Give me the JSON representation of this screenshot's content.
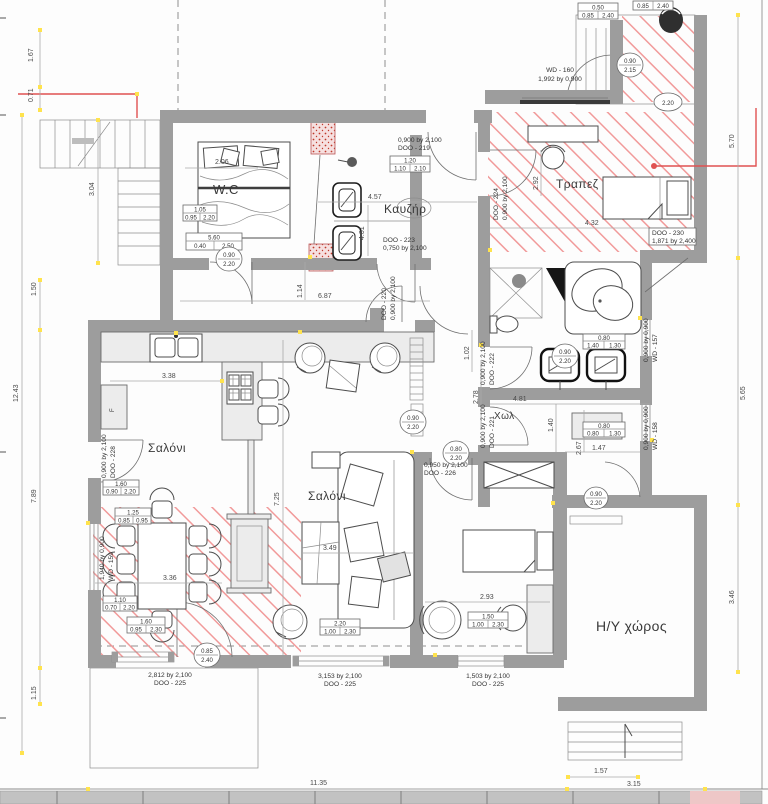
{
  "rooms": {
    "wc": "W.C",
    "boiler": "Καυζήρ",
    "dining": "Τραπεζ",
    "living_left": "Σαλόνι",
    "living_center": "Σαλόνι",
    "hall": "Χωλ",
    "computer_room": "Η/Υ χώρος",
    "fridge": "F"
  },
  "doors": {
    "d219": {
      "size": "0,900 by 2,100",
      "code": "DOO - 219"
    },
    "d220": {
      "code": "DOO - 220",
      "size": "0,900 by 2,100"
    },
    "d221": {
      "size": "0,900 by 2,100",
      "code": "DOO - 221"
    },
    "d222": {
      "size": "0,900 by 2,100",
      "code": "DOO - 222"
    },
    "d223": {
      "code": "DOO - 223",
      "size": "0,750 by 2,100"
    },
    "d224": {
      "code": "DOO - 224",
      "size": "0,900 by 2,100"
    },
    "d225a": {
      "size": "2,812 by 2,100",
      "code": "DOO - 225"
    },
    "d225b": {
      "size": "3,153 by 2,100",
      "code": "DOO - 225"
    },
    "d225c": {
      "size": "1,503 by 2,100",
      "code": "DOO - 225"
    },
    "d226": {
      "size": "0,950 by 2,100",
      "code": "DOO - 226"
    },
    "d228": {
      "size": "0,900 by 2,100",
      "code": "DOO - 228"
    },
    "d230": {
      "code": "DOO - 230",
      "size": "1,871 by 2,400"
    }
  },
  "windows": {
    "w157": {
      "size": "0,900 by 0,900",
      "code": "WD - 157"
    },
    "w158": {
      "size": "0,900 by 0,900",
      "code": "WD - 158"
    },
    "w159": {
      "size": "1,940 by 0,900",
      "code": "WD - 159"
    },
    "w160": {
      "code": "WD - 160",
      "size": "1,992 by 0,900"
    }
  },
  "dimensions": {
    "left": [
      "1.67",
      "0.71",
      "3.04",
      "1.50",
      "12.43",
      "7.89",
      "1.15"
    ],
    "right": [
      "5.70",
      "5.65",
      "3.46"
    ],
    "bottom": [
      "11.35",
      "1.57",
      "3.15"
    ],
    "interior": {
      "a206": "2.06",
      "a457": "4.57",
      "a401": "4.01",
      "a114": "1.14",
      "a687": "6.87",
      "a292": "2.92",
      "a432": "4.32",
      "a102": "1.02",
      "a278": "2.78",
      "a338": "3.38",
      "a725": "7.25",
      "a349": "3.49",
      "a336": "3.36",
      "a293": "2.93",
      "a481": "4.81",
      "a140": "1.40",
      "a267": "2.67",
      "a147": "1.47"
    }
  },
  "dim_boxes": {
    "b1": {
      "top": "0.50",
      "l": "0.85",
      "r": "2.40"
    },
    "b2": {
      "l": "0.85",
      "r": "2.40"
    },
    "b3": {
      "top": "1.20",
      "l": "1.10",
      "r": "2.10"
    },
    "b4": {
      "top": "5.60",
      "l": "0.40",
      "r": "2.50"
    },
    "b5": {
      "top": "1.05",
      "l": "0.95",
      "r": "2.20"
    },
    "b6": {
      "top": "0.80",
      "l": "1.40",
      "r": "1.30"
    },
    "b7": {
      "top": "0.80",
      "l": "0.80",
      "r": "1.30"
    },
    "b8": {
      "top": "1.60",
      "l": "0.90",
      "r": "2.20"
    },
    "b9": {
      "top": "1.25",
      "l": "0.85",
      "r": "0.95"
    },
    "b10": {
      "top": "1.10",
      "l": "0.70",
      "r": "2.20"
    },
    "b11": {
      "top": "1.60",
      "l": "0.95",
      "r": "2.30"
    },
    "b12": {
      "top": "2.20",
      "l": "1.00",
      "r": "2.30"
    },
    "b13": {
      "top": "1.50",
      "l": "1.00",
      "r": "2.30"
    }
  },
  "dim_circles": {
    "c1": {
      "top": "0.90",
      "bot": "2.20"
    },
    "c2": {
      "top": "0.90",
      "bot": "2.15"
    },
    "c3": {
      "top": "2.20",
      "bot": ""
    },
    "c4": {
      "top": "0.90",
      "bot": "2.20"
    },
    "c5": {
      "top": "0.90",
      "bot": "2.20"
    },
    "c6": {
      "top": "0.80",
      "bot": "2.20"
    },
    "c7": {
      "top": "0.85",
      "bot": "2.40"
    },
    "c8": {
      "top": "0.90",
      "bot": "2.20"
    }
  },
  "colors": {
    "wall": "#9d9d9d",
    "hatch_red": "#f08c8c",
    "stipple_red": "#c0392b",
    "annotation_red": "#e05252",
    "marker_yellow": "#ffe34d"
  }
}
